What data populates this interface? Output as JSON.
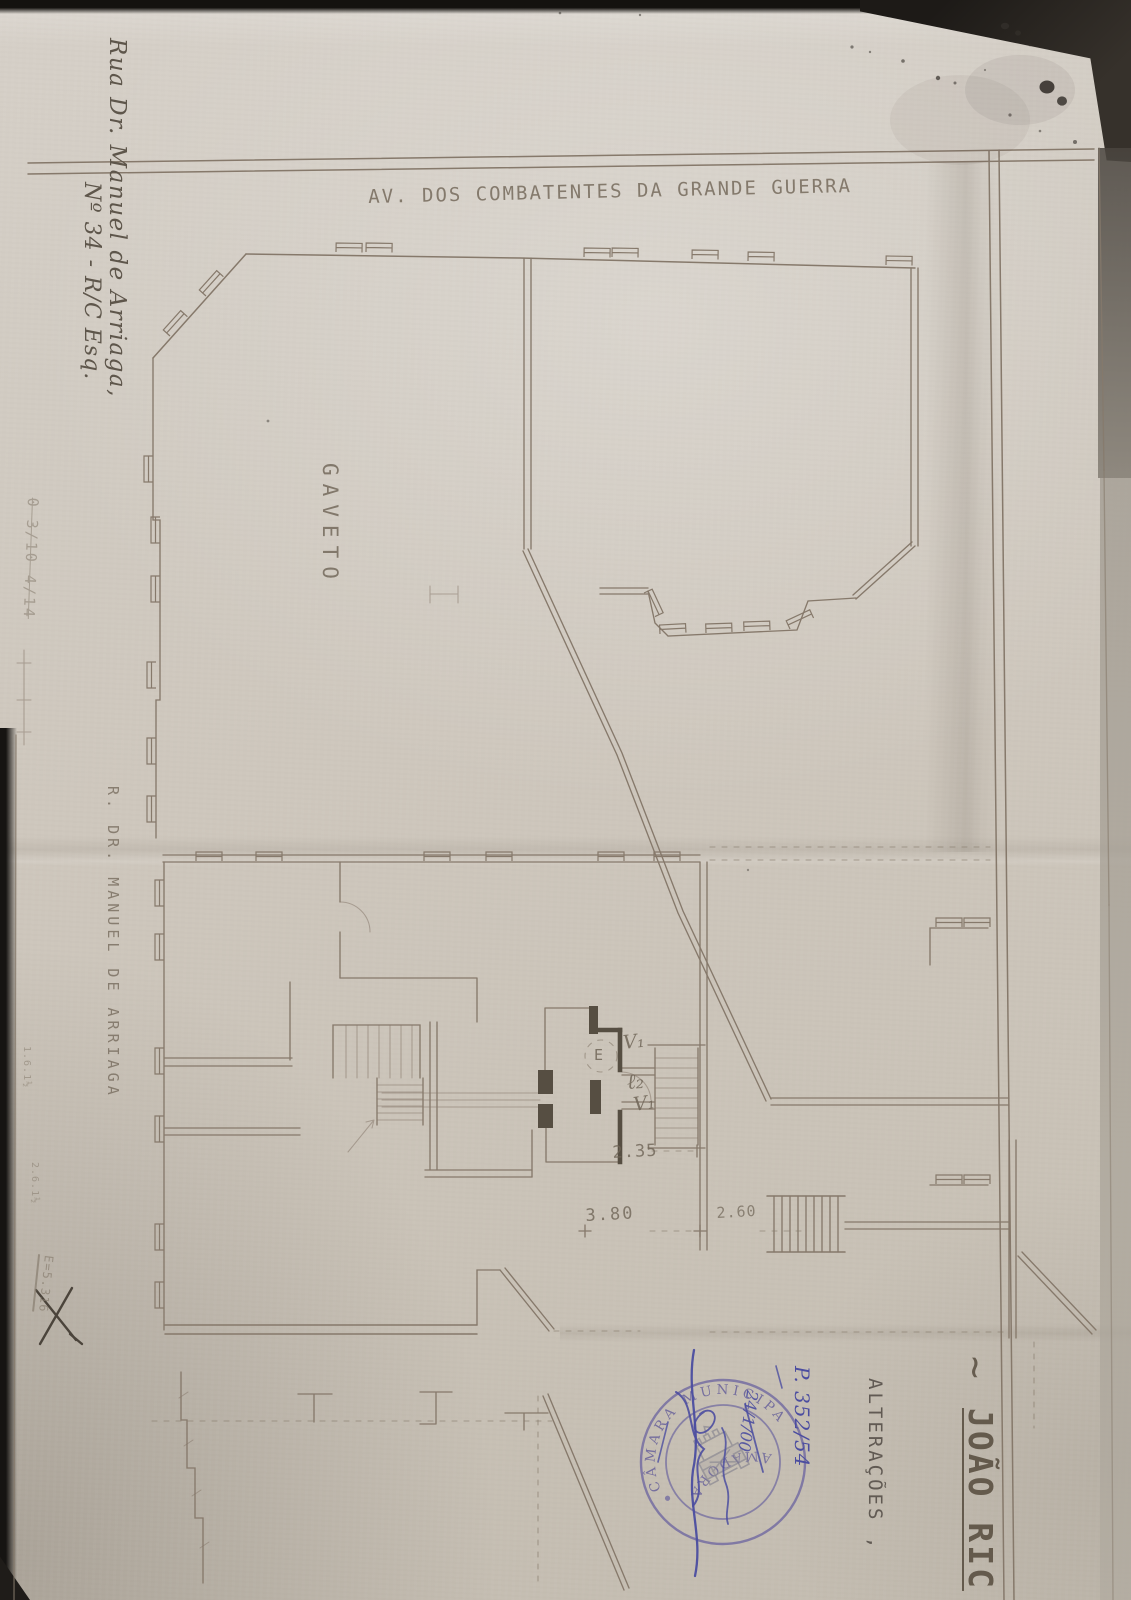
{
  "t": {
    "street_top": "AV. DOS COMBATENTES DA GRANDE GUERRA",
    "gaveto": "GAVETO",
    "street_left": "R. DR. MANUEL DE ARRIAGA",
    "address_hand_1": "Rua Dr. Manuel de Arriaga,",
    "address_hand_2": "Nº 34 - R/C Esq.",
    "note_top_left": "0 3/10 4/14",
    "note_mid_left_1": "1.6.1½",
    "note_mid_left_2": "2.6.1½",
    "note_bottom_left": "E=5.316",
    "dim_1": "2.35",
    "dim_2": "3.80",
    "dim_3": "2.60",
    "label_v1_top": "V₁",
    "label_l2": "ℓ₂",
    "label_v1_bottom": "V₁",
    "label_e": "E",
    "stamp_arc_top": "CÂMARA MUNICIPAL DA",
    "stamp_arc_bottom": "AMADORA",
    "pen_process": "P. 352/54",
    "pen_date": "24/1/00",
    "title_alteracoes": "ALTERAÇÕES ,",
    "title_tilde": "~",
    "title_name": "JOÃO RIC"
  },
  "colors": {
    "paper": "#cfc8bf",
    "pencil": "#86796b",
    "pen_blue": "#4b4da0",
    "stamp_violet": "#6f68a0"
  }
}
